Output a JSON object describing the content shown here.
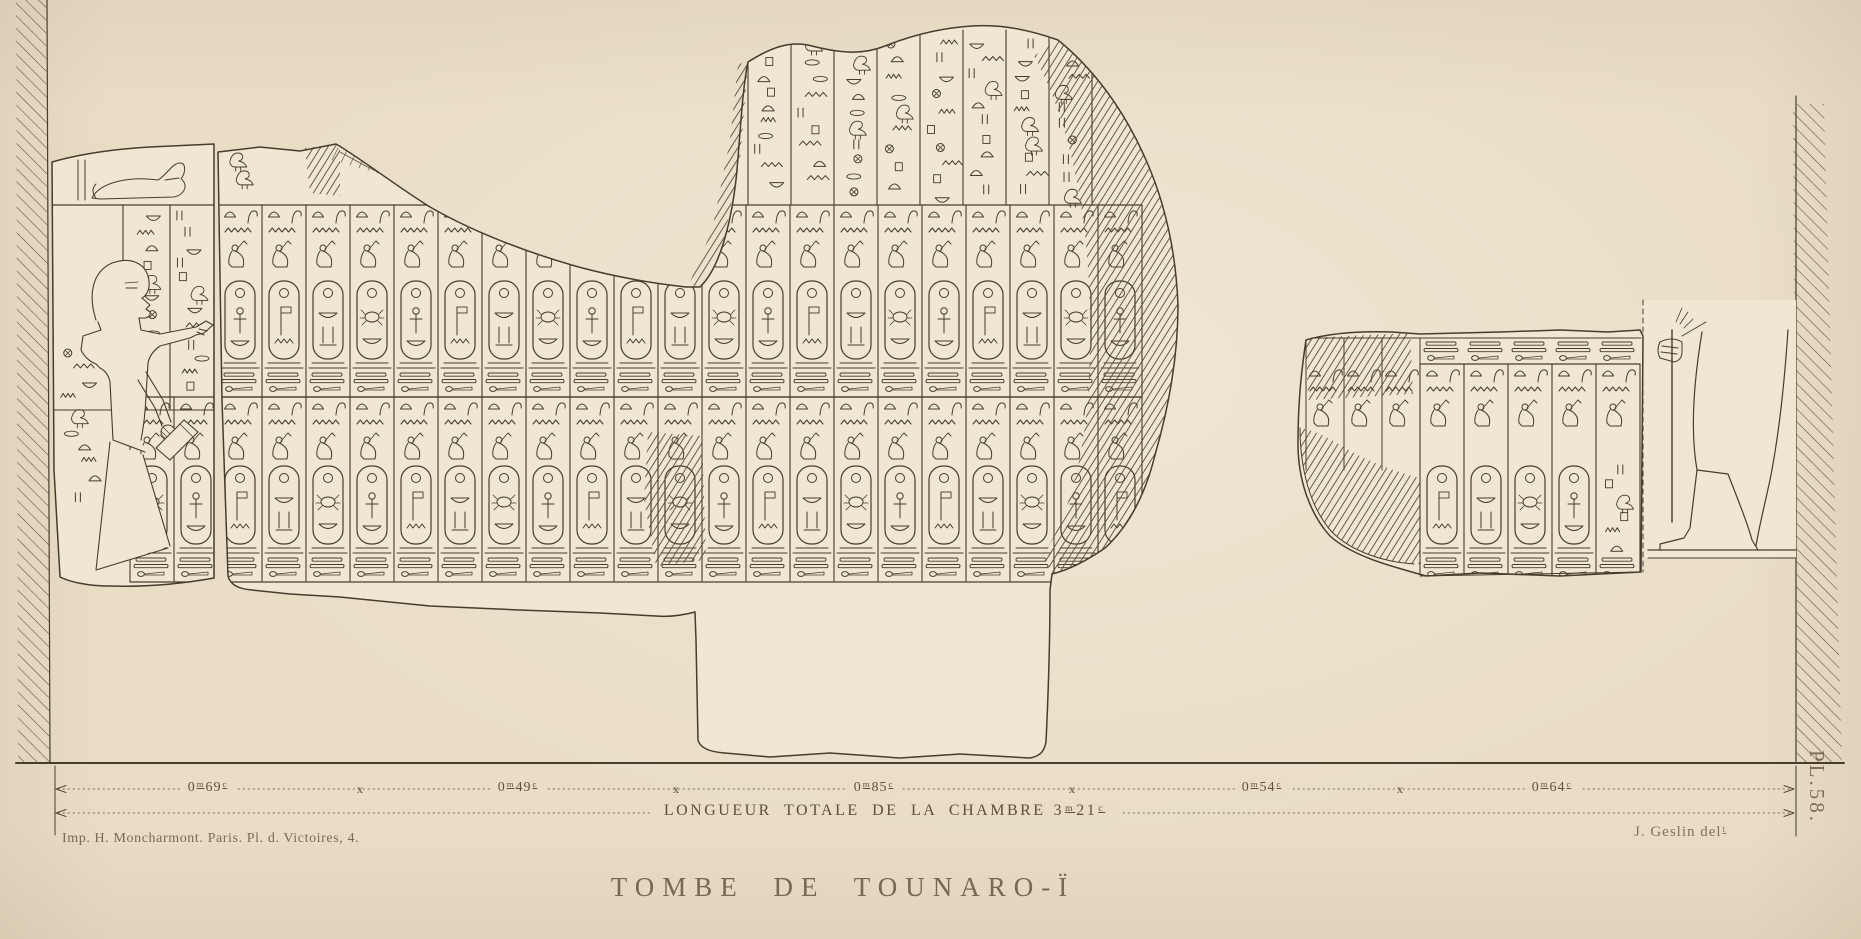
{
  "plate": {
    "title": "TOMBE DE TOUNARO-Ï",
    "plate_number": "PL.58.",
    "imprint": "Imp. H. Moncharmont. Paris. Pl. d. Victoires, 4.",
    "signature": "J. Geslin del",
    "signature_superscript": "t",
    "paper_color": "#e9ddc6",
    "fragment_color": "#f0e6d1",
    "ink_color": "#473c2d",
    "text_color": "#6b5b45"
  },
  "measurements": {
    "separator": "x",
    "segments": [
      {
        "meters": "0",
        "unit_m": "m",
        "value": "69",
        "unit_c": "c"
      },
      {
        "meters": "0",
        "unit_m": "m",
        "value": "49",
        "unit_c": "c"
      },
      {
        "meters": "0",
        "unit_m": "m",
        "value": "85",
        "unit_c": "c"
      },
      {
        "meters": "0",
        "unit_m": "m",
        "value": "54",
        "unit_c": "c"
      },
      {
        "meters": "0",
        "unit_m": "m",
        "value": "64",
        "unit_c": "c"
      }
    ],
    "total": {
      "label": "LONGUEUR TOTALE DE LA CHAMBRE",
      "meters": "3",
      "unit_m": "m",
      "centimeters": "21",
      "unit_c": "c"
    }
  }
}
